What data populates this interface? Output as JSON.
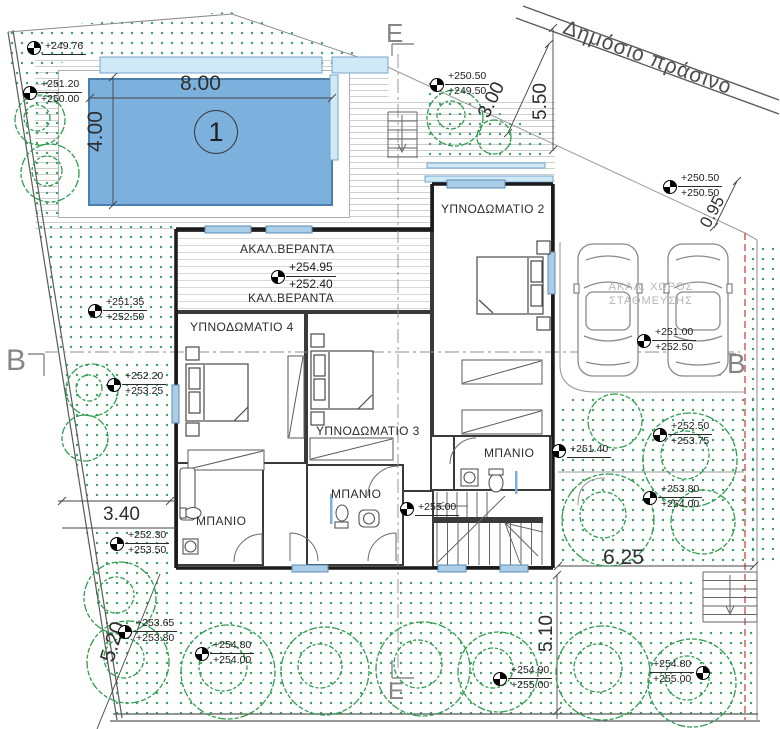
{
  "boundary": {
    "label": "Δημόσιο πράσινο"
  },
  "sections": {
    "e_top": "E",
    "e_bottom": "E",
    "b_left": "B",
    "b_right": "B"
  },
  "pool": {
    "number": "1",
    "length": "8.00",
    "width": "4.00"
  },
  "dimensions": {
    "d300": "3.00",
    "d550": "5.50",
    "d095": "0.95",
    "d340": "3.40",
    "d520": "5.20",
    "d625": "6.25",
    "d510": "5.10"
  },
  "rooms": {
    "bedroom2": "ΥΠΝΟΔΩΜΑΤΙΟ 2",
    "bedroom3": "ΥΠΝΟΔΩΜΑΤΙΟ 3",
    "bedroom4": "ΥΠΝΟΔΩΜΑΤΙΟ 4",
    "bath1": "ΜΠΑΝΙΟ",
    "bath2": "ΜΠΑΝΙΟ",
    "bath3": "ΜΠΑΝΙΟ"
  },
  "veranda": {
    "uncovered": "ΑΚΑΛ.ΒΕΡΑΝΤΑ",
    "upper_level": "+254.95",
    "lower_level": "+252.40",
    "covered": "ΚΑΛ.ΒΕΡΑΝΤΑ"
  },
  "parking": {
    "line1": "ΑΚΑΛ. ΧΩΡΟΣ",
    "line2": "ΣΤΑΘΜΕΥΣΗΣ"
  },
  "levels": [
    {
      "v1": "+249.76",
      "v2": ""
    },
    {
      "v1": "+251.20",
      "v2": "+250.00"
    },
    {
      "v1": "+250.50",
      "v2": "+249.50"
    },
    {
      "v1": "+250.50",
      "v2": "+250.50"
    },
    {
      "v1": "+251.35",
      "v2": "+252.50"
    },
    {
      "v1": "+252.20",
      "v2": "+253.25"
    },
    {
      "v1": "+251.00",
      "v2": "+252.50"
    },
    {
      "v1": "+251.40",
      "v2": ""
    },
    {
      "v1": "+255.00",
      "v2": ""
    },
    {
      "v1": "+252.50",
      "v2": "+253.75"
    },
    {
      "v1": "+253.80",
      "v2": "+254.00"
    },
    {
      "v1": "+252.30",
      "v2": "+253.50"
    },
    {
      "v1": "+253.65",
      "v2": "+253.80"
    },
    {
      "v1": "+254.80",
      "v2": "+254.00"
    },
    {
      "v1": "+254.90",
      "v2": "+255.00"
    },
    {
      "v1": "+254.80",
      "v2": "+255.00"
    }
  ],
  "colors": {
    "pool_water": "#7db1dd",
    "pool_edge": "#cfe9f6",
    "tree": "#2f9e4f",
    "boundary_red": "#cc4444",
    "wall": "#3a3a3a"
  }
}
